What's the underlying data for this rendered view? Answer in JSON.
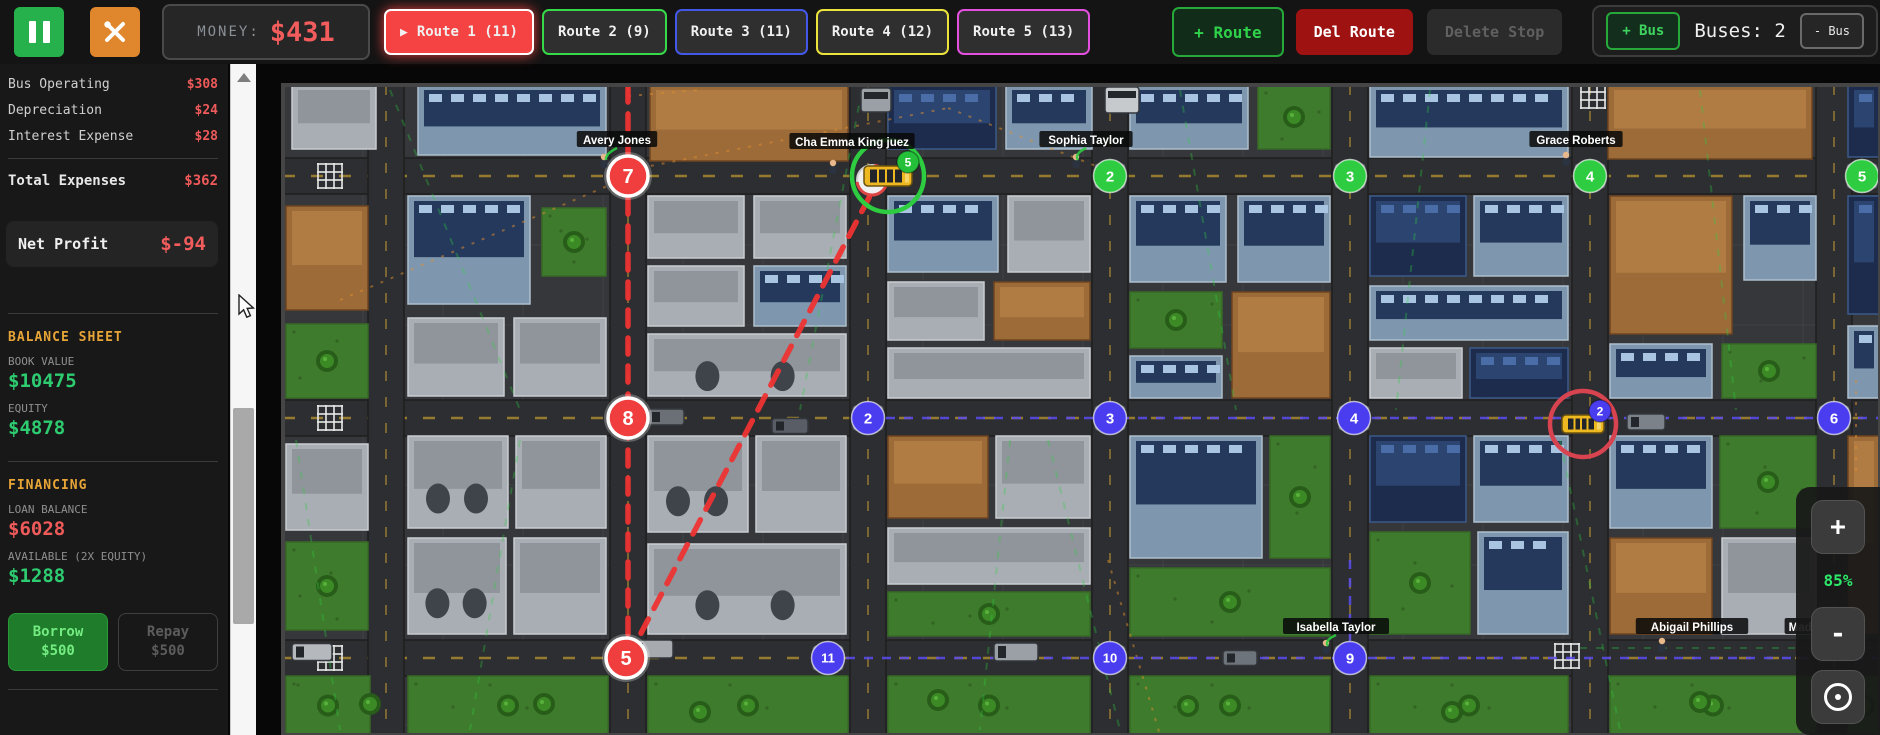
{
  "toolbar": {
    "money_label": "MONEY:",
    "money_value": "$431",
    "routes": [
      {
        "label": "Route 1 (11)",
        "color": "#f54343",
        "active": true
      },
      {
        "label": "Route 2 (9)",
        "color": "#35d94a",
        "active": false
      },
      {
        "label": "Route 3 (11)",
        "color": "#4458e8",
        "active": false
      },
      {
        "label": "Route 4 (12)",
        "color": "#ece23c",
        "active": false
      },
      {
        "label": "Route 5 (13)",
        "color": "#e44fe0",
        "active": false
      }
    ],
    "add_route_label": "+ Route",
    "del_route_label": "Del Route",
    "delete_stop_label": "Delete Stop",
    "bus_panel": {
      "add_bus": "+ Bus",
      "buses_count": "Buses: 2",
      "remove_bus": "- Bus"
    }
  },
  "sidebar": {
    "expense_rows": [
      {
        "label": "Bus Operating",
        "value": "$308"
      },
      {
        "label": "Depreciation",
        "value": "$24"
      },
      {
        "label": "Interest Expense",
        "value": "$28"
      }
    ],
    "total": {
      "label": "Total Expenses",
      "value": "$362"
    },
    "net_profit": {
      "label": "Net Profit",
      "value": "$-94"
    },
    "balance_sheet": {
      "title": "BALANCE SHEET",
      "items": [
        {
          "label": "BOOK VALUE",
          "value": "$10475",
          "color": "green"
        },
        {
          "label": "EQUITY",
          "value": "$4878",
          "color": "green"
        }
      ]
    },
    "financing": {
      "title": "FINANCING",
      "items": [
        {
          "label": "LOAN BALANCE",
          "value": "$6028",
          "color": "red"
        },
        {
          "label": "AVAILABLE (2X EQUITY)",
          "value": "$1288",
          "color": "green"
        }
      ]
    },
    "borrow": {
      "line1": "Borrow",
      "line2": "$500"
    },
    "repay": {
      "line1": "Repay",
      "line2": "$500"
    }
  },
  "map": {
    "zoom_controls": {
      "zoom_in": "+",
      "zoom_level": "85%",
      "zoom_out": "-"
    },
    "stops": [
      {
        "n": "7",
        "x": 628,
        "y": 176,
        "color": "red"
      },
      {
        "n": "8",
        "x": 628,
        "y": 418,
        "color": "red"
      },
      {
        "n": "5",
        "x": 626,
        "y": 658,
        "color": "red"
      },
      {
        "n": "2",
        "x": 1110,
        "y": 176,
        "color": "green"
      },
      {
        "n": "3",
        "x": 1350,
        "y": 176,
        "color": "green"
      },
      {
        "n": "4",
        "x": 1590,
        "y": 176,
        "color": "green"
      },
      {
        "n": "5",
        "x": 1862,
        "y": 176,
        "color": "green"
      },
      {
        "n": "2",
        "x": 868,
        "y": 418,
        "color": "blue"
      },
      {
        "n": "3",
        "x": 1110,
        "y": 418,
        "color": "blue"
      },
      {
        "n": "4",
        "x": 1354,
        "y": 418,
        "color": "blue"
      },
      {
        "n": "6",
        "x": 1834,
        "y": 418,
        "color": "blue"
      },
      {
        "n": "11",
        "x": 828,
        "y": 658,
        "color": "blue"
      },
      {
        "n": "10",
        "x": 1110,
        "y": 658,
        "color": "blue"
      },
      {
        "n": "9",
        "x": 1350,
        "y": 658,
        "color": "blue"
      }
    ],
    "white_stop": {
      "x": 872,
      "y": 180
    },
    "buses": [
      {
        "x": 888,
        "y": 176,
        "w": 48,
        "h": 20,
        "ring": "#2ecc40",
        "badge": "5",
        "badge_color": "#24c03a"
      },
      {
        "x": 1583,
        "y": 424,
        "w": 42,
        "h": 18,
        "ring": "#d84350",
        "badge": "2",
        "badge_color": "#4a3df0"
      }
    ],
    "pedestrian_labels": [
      {
        "name": "Avery Jones",
        "x": 617,
        "y": 140
      },
      {
        "name": "Cha Emma King juez",
        "x": 852,
        "y": 142
      },
      {
        "name": "Sophia Taylor",
        "x": 1086,
        "y": 140
      },
      {
        "name": "Grace Roberts",
        "x": 1576,
        "y": 140
      },
      {
        "name": "Isabella Taylor",
        "x": 1336,
        "y": 627
      },
      {
        "name": "Abigail Phillips",
        "x": 1692,
        "y": 627
      },
      {
        "name": "Madison",
        "x": 1812,
        "y": 627
      }
    ],
    "persons": [
      [
        604,
        162
      ],
      [
        833,
        168
      ],
      [
        1076,
        162
      ],
      [
        1566,
        160
      ],
      [
        1326,
        648
      ],
      [
        1662,
        646
      ]
    ],
    "connectors": [
      [
        617,
        148,
        606,
        160
      ],
      [
        1086,
        148,
        1078,
        160
      ],
      [
        1336,
        635,
        1328,
        646
      ]
    ],
    "roads": {
      "vertical_x": [
        386,
        628,
        868,
        1110,
        1350,
        1590,
        1834
      ],
      "horizontal_y": [
        176,
        418,
        658
      ]
    },
    "red_route_segments": [
      [
        628,
        86,
        628,
        658
      ],
      [
        628,
        658,
        872,
        192
      ]
    ],
    "blue_route_segments": [
      [
        868,
        418,
        1880,
        418
      ],
      [
        828,
        658,
        1880,
        658
      ],
      [
        1350,
        560,
        1350,
        658
      ]
    ],
    "green_decor_lines": [
      [
        390,
        90,
        520,
        410
      ],
      [
        520,
        440,
        470,
        730
      ],
      [
        862,
        90,
        800,
        410
      ],
      [
        1048,
        440,
        1120,
        730
      ],
      [
        1180,
        90,
        1236,
        410
      ],
      [
        1430,
        90,
        1396,
        410
      ],
      [
        1560,
        440,
        1620,
        730
      ],
      [
        1010,
        440,
        980,
        730
      ],
      [
        1700,
        90,
        1736,
        410
      ],
      [
        296,
        440,
        340,
        730
      ],
      [
        1580,
        648,
        1880,
        648
      ]
    ],
    "orange_decor_lines": [
      [
        640,
        168,
        948,
        108
      ],
      [
        948,
        108,
        1106,
        170
      ],
      [
        340,
        300,
        626,
        178
      ],
      [
        1856,
        380,
        1856,
        478
      ],
      [
        628,
        96,
        700,
        90
      ],
      [
        1108,
        560,
        1160,
        735
      ]
    ],
    "crosswalks": [
      [
        330,
        176
      ],
      [
        330,
        418
      ],
      [
        330,
        658
      ],
      [
        1567,
        656
      ],
      [
        1593,
        96
      ]
    ],
    "vehicles": [
      {
        "x": 666,
        "y": 417,
        "w": 36,
        "h": 16,
        "c": "#6b7077"
      },
      {
        "x": 790,
        "y": 426,
        "w": 36,
        "h": 15,
        "c": "#595e66"
      },
      {
        "x": 1646,
        "y": 422,
        "w": 38,
        "h": 16,
        "c": "#7c828a"
      },
      {
        "x": 652,
        "y": 649,
        "w": 42,
        "h": 18,
        "c": "#a7abb0"
      },
      {
        "x": 1016,
        "y": 652,
        "w": 44,
        "h": 18,
        "c": "#9aa0a6"
      },
      {
        "x": 312,
        "y": 652,
        "w": 40,
        "h": 17,
        "c": "#b5b9be"
      },
      {
        "x": 1240,
        "y": 658,
        "w": 34,
        "h": 15,
        "c": "#6e747b"
      },
      {
        "x": 1122,
        "y": 100,
        "w": 26,
        "h": 34,
        "c": "#c7cacd",
        "vert": true
      },
      {
        "x": 876,
        "y": 100,
        "w": 24,
        "h": 30,
        "c": "#9aa0a6",
        "vert": true
      }
    ],
    "buildings": [
      [
        292,
        85,
        84,
        64,
        "industrial"
      ],
      [
        418,
        85,
        188,
        70,
        "office"
      ],
      [
        650,
        85,
        198,
        76,
        "brown"
      ],
      [
        888,
        85,
        108,
        64,
        "navy"
      ],
      [
        1006,
        85,
        86,
        64,
        "office"
      ],
      [
        1130,
        85,
        118,
        64,
        "office"
      ],
      [
        1258,
        85,
        72,
        64,
        "grass"
      ],
      [
        1370,
        85,
        198,
        72,
        "office"
      ],
      [
        1608,
        85,
        204,
        74,
        "brown"
      ],
      [
        1848,
        85,
        32,
        72,
        "navy"
      ],
      [
        286,
        206,
        82,
        104,
        "brown"
      ],
      [
        286,
        324,
        82,
        74,
        "grass"
      ],
      [
        408,
        196,
        122,
        108,
        "office"
      ],
      [
        542,
        208,
        64,
        68,
        "grass"
      ],
      [
        408,
        318,
        96,
        78,
        "industrial"
      ],
      [
        514,
        318,
        92,
        78,
        "industrial"
      ],
      [
        648,
        196,
        96,
        62,
        "industrial"
      ],
      [
        754,
        196,
        92,
        62,
        "industrial"
      ],
      [
        648,
        266,
        96,
        60,
        "industrial"
      ],
      [
        754,
        266,
        92,
        60,
        "office"
      ],
      [
        648,
        334,
        198,
        62,
        "tanks"
      ],
      [
        888,
        196,
        110,
        76,
        "office"
      ],
      [
        1008,
        196,
        82,
        76,
        "industrial"
      ],
      [
        888,
        282,
        96,
        58,
        "industrial"
      ],
      [
        994,
        282,
        96,
        58,
        "brown"
      ],
      [
        888,
        348,
        202,
        50,
        "industrial"
      ],
      [
        1130,
        196,
        96,
        86,
        "office"
      ],
      [
        1238,
        196,
        92,
        86,
        "office"
      ],
      [
        1130,
        292,
        92,
        56,
        "grass"
      ],
      [
        1232,
        292,
        98,
        106,
        "brown"
      ],
      [
        1130,
        356,
        92,
        42,
        "office"
      ],
      [
        1370,
        196,
        96,
        80,
        "navy"
      ],
      [
        1474,
        196,
        94,
        80,
        "office"
      ],
      [
        1370,
        286,
        198,
        54,
        "office"
      ],
      [
        1370,
        348,
        92,
        50,
        "industrial"
      ],
      [
        1470,
        348,
        98,
        50,
        "navy"
      ],
      [
        1610,
        196,
        122,
        138,
        "brown"
      ],
      [
        1744,
        196,
        72,
        84,
        "office"
      ],
      [
        1610,
        344,
        102,
        54,
        "office"
      ],
      [
        1722,
        344,
        94,
        54,
        "grass"
      ],
      [
        1848,
        196,
        32,
        118,
        "navy"
      ],
      [
        1848,
        326,
        32,
        72,
        "office"
      ],
      [
        286,
        444,
        82,
        86,
        "industrial"
      ],
      [
        286,
        542,
        82,
        88,
        "grass"
      ],
      [
        408,
        436,
        100,
        92,
        "tanks"
      ],
      [
        516,
        436,
        90,
        92,
        "industrial"
      ],
      [
        408,
        538,
        98,
        96,
        "tanks"
      ],
      [
        514,
        538,
        92,
        96,
        "industrial"
      ],
      [
        648,
        436,
        100,
        96,
        "tanks"
      ],
      [
        756,
        436,
        90,
        96,
        "industrial"
      ],
      [
        648,
        544,
        198,
        90,
        "tanks"
      ],
      [
        888,
        436,
        100,
        82,
        "brown"
      ],
      [
        996,
        436,
        94,
        82,
        "industrial"
      ],
      [
        888,
        528,
        202,
        56,
        "industrial"
      ],
      [
        888,
        592,
        202,
        44,
        "grass"
      ],
      [
        1130,
        436,
        132,
        122,
        "office"
      ],
      [
        1270,
        436,
        60,
        122,
        "grass"
      ],
      [
        1130,
        568,
        200,
        68,
        "grass"
      ],
      [
        1370,
        436,
        96,
        86,
        "navy"
      ],
      [
        1474,
        436,
        94,
        86,
        "office"
      ],
      [
        1370,
        532,
        100,
        102,
        "grass"
      ],
      [
        1478,
        532,
        90,
        102,
        "office"
      ],
      [
        1610,
        436,
        102,
        92,
        "office"
      ],
      [
        1720,
        436,
        96,
        92,
        "grass"
      ],
      [
        1610,
        538,
        102,
        96,
        "brown"
      ],
      [
        1722,
        538,
        94,
        96,
        "industrial"
      ],
      [
        1848,
        436,
        32,
        198,
        "brown"
      ],
      [
        286,
        676,
        84,
        59,
        "grass"
      ],
      [
        408,
        676,
        200,
        59,
        "grass"
      ],
      [
        648,
        676,
        200,
        59,
        "grass"
      ],
      [
        888,
        676,
        202,
        59,
        "grass"
      ],
      [
        1130,
        676,
        200,
        59,
        "grass"
      ],
      [
        1370,
        676,
        198,
        59,
        "grass"
      ],
      [
        1610,
        676,
        206,
        59,
        "grass"
      ],
      [
        1848,
        676,
        32,
        59,
        "grass"
      ]
    ],
    "extra_trees": [
      [
        544,
        704
      ],
      [
        700,
        712
      ],
      [
        938,
        700
      ],
      [
        1188,
        706
      ],
      [
        1452,
        712
      ],
      [
        1700,
        702
      ],
      [
        370,
        704
      ]
    ]
  },
  "colors": {
    "stop_red": "#f03e3e",
    "stop_green": "#2ecc40",
    "stop_blue": "#4a3df0",
    "route_active_red": "#ee3333",
    "route_blue_dash": "#5a4cf0",
    "money_red": "#f25c5c",
    "value_green": "#2ecc71",
    "section_orange": "#e8a537"
  }
}
